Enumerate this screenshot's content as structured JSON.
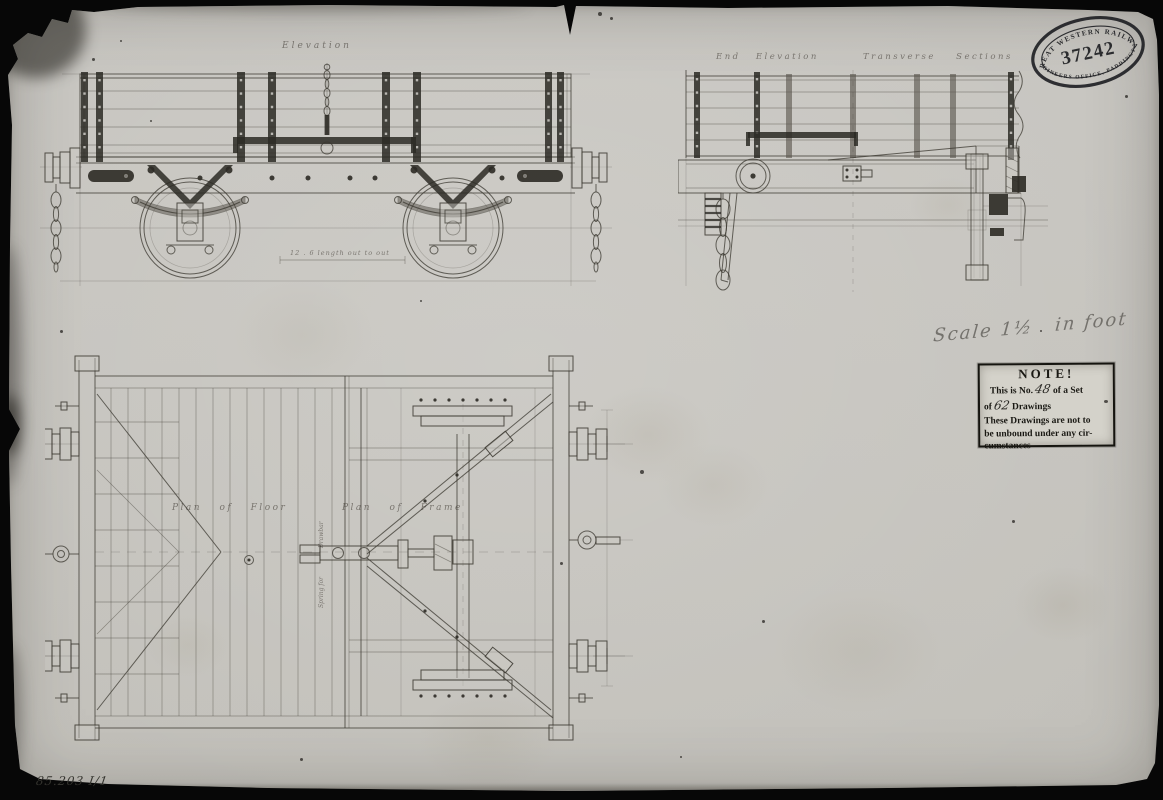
{
  "colors": {
    "paper": "#c6c4bf",
    "ink": "#3a372f",
    "stamp_ink": "#16171b",
    "pencil": "#8a8a85"
  },
  "stamp": {
    "arc_top": "GREAT WESTERN RAILWAY",
    "number": "37242",
    "arc_bottom": "ENGINEERS OFFICE, PADDINGTON"
  },
  "note_box": {
    "title": "NOTE!",
    "line1_pre": "This is No.",
    "line1_num": "48",
    "line1_post": "of a Set",
    "line2_pre": "of",
    "line2_num": "62",
    "line2_post": "Drawings",
    "body_line1": "These Drawings are not to",
    "body_line2": "be unbound under any cir-",
    "body_line3": "cumstances"
  },
  "view_labels": {
    "side_elevation": "Elevation",
    "end_elevation": "End Elevation",
    "transverse_sections": "Transverse Sections",
    "plan_of_floor": "Plan of Floor",
    "plan_of_frame": "Plan of Frame",
    "spring_label_upper": "Drawbar",
    "spring_label_lower": "Spring for",
    "dimension_note": "12 . 6 length out to out"
  },
  "handwritten": {
    "scale_note_1": "Scale 1½",
    "scale_note_2": "in foot",
    "reference_number": "85.203 I/1"
  }
}
